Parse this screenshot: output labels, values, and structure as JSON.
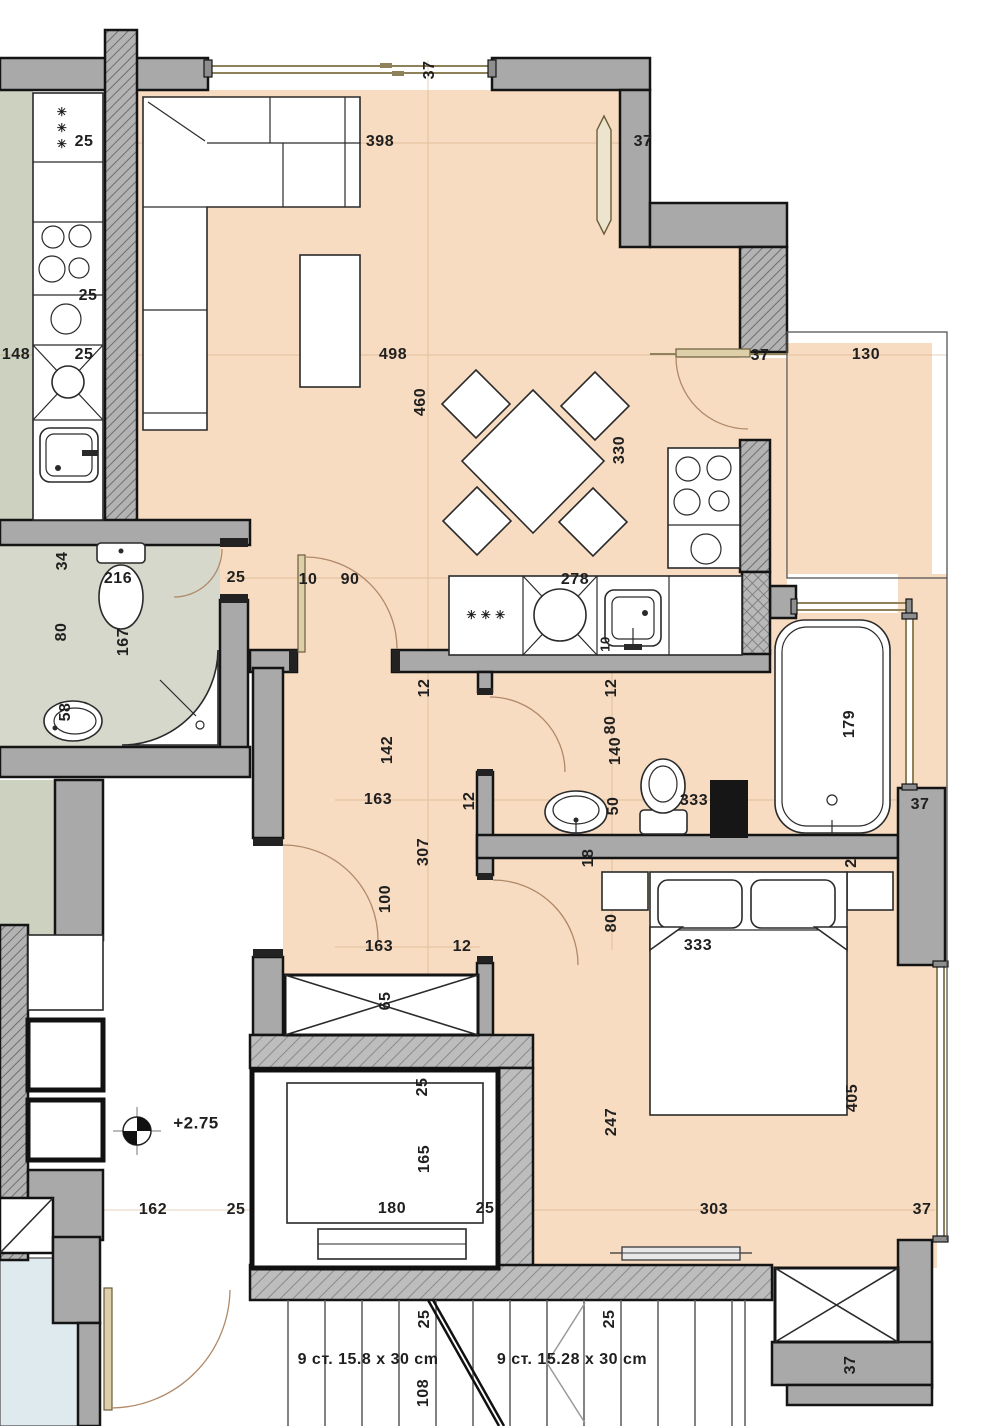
{
  "plan_title": "apartment floor plan",
  "colors": {
    "peach": "#f8dcc2",
    "wall_gray": "#a9a9a9",
    "hatch_gray": "#b3b3b3",
    "hatch_line": "#6e6e6e",
    "green_floor": "#d5d8ca",
    "green_strip": "#ccd2bf",
    "blue_floor": "#dfeaee",
    "window_tan": "#8f815a",
    "outline": "#141414",
    "label_color": "#1f1f1f"
  },
  "level_marker": "+2.75",
  "stairs": {
    "left_flight": "9 ст. 15.8 x 30 cm",
    "right_flight": "9 ст. 15.28 x 30 cm"
  },
  "labels": [
    {
      "t": "37",
      "x": 430,
      "y": 70,
      "r": -90
    },
    {
      "t": "25",
      "x": 84,
      "y": 142,
      "r": 0
    },
    {
      "t": "398",
      "x": 380,
      "y": 142,
      "r": 0
    },
    {
      "t": "37",
      "x": 643,
      "y": 142,
      "r": 0
    },
    {
      "t": "25",
      "x": 88,
      "y": 296,
      "r": 0
    },
    {
      "t": "148",
      "x": 16,
      "y": 355,
      "r": 0
    },
    {
      "t": "25",
      "x": 84,
      "y": 355,
      "r": 0
    },
    {
      "t": "498",
      "x": 393,
      "y": 355,
      "r": 0
    },
    {
      "t": "37",
      "x": 760,
      "y": 356,
      "r": 0
    },
    {
      "t": "130",
      "x": 866,
      "y": 355,
      "r": 0
    },
    {
      "t": "460",
      "x": 421,
      "y": 402,
      "r": -90
    },
    {
      "t": "330",
      "x": 620,
      "y": 450,
      "r": -90
    },
    {
      "t": "34",
      "x": 63,
      "y": 561,
      "r": -90
    },
    {
      "t": "216",
      "x": 118,
      "y": 579,
      "r": 0
    },
    {
      "t": "25",
      "x": 236,
      "y": 578,
      "r": 0
    },
    {
      "t": "10",
      "x": 308,
      "y": 580,
      "r": 0
    },
    {
      "t": "90",
      "x": 350,
      "y": 580,
      "r": 0
    },
    {
      "t": "278",
      "x": 575,
      "y": 580,
      "r": 0
    },
    {
      "t": "80",
      "x": 62,
      "y": 632,
      "r": -90
    },
    {
      "t": "167",
      "x": 124,
      "y": 642,
      "r": -90
    },
    {
      "t": "10",
      "x": 605,
      "y": 644,
      "r": -90,
      "s": 13
    },
    {
      "t": "12",
      "x": 425,
      "y": 688,
      "r": -90
    },
    {
      "t": "12",
      "x": 612,
      "y": 688,
      "r": -90
    },
    {
      "t": "58",
      "x": 66,
      "y": 712,
      "r": -90
    },
    {
      "t": "179",
      "x": 850,
      "y": 724,
      "r": -90
    },
    {
      "t": "142",
      "x": 388,
      "y": 750,
      "r": -90
    },
    {
      "t": "80",
      "x": 611,
      "y": 725,
      "r": -90
    },
    {
      "t": "140",
      "x": 616,
      "y": 751,
      "r": -90
    },
    {
      "t": "163",
      "x": 378,
      "y": 800,
      "r": 0
    },
    {
      "t": "12",
      "x": 470,
      "y": 801,
      "r": -90
    },
    {
      "t": "50",
      "x": 614,
      "y": 806,
      "r": -90
    },
    {
      "t": "333",
      "x": 694,
      "y": 801,
      "r": 0
    },
    {
      "t": "37",
      "x": 920,
      "y": 805,
      "r": 0
    },
    {
      "t": "307",
      "x": 424,
      "y": 852,
      "r": -90
    },
    {
      "t": "18",
      "x": 589,
      "y": 858,
      "r": -90
    },
    {
      "t": "2",
      "x": 852,
      "y": 863,
      "r": -90
    },
    {
      "t": "100",
      "x": 386,
      "y": 899,
      "r": -90
    },
    {
      "t": "80",
      "x": 612,
      "y": 923,
      "r": -90
    },
    {
      "t": "163",
      "x": 379,
      "y": 947,
      "r": 0
    },
    {
      "t": "12",
      "x": 462,
      "y": 947,
      "r": 0
    },
    {
      "t": "333",
      "x": 698,
      "y": 946,
      "r": 0
    },
    {
      "t": "65",
      "x": 386,
      "y": 1001,
      "r": -90
    },
    {
      "t": "+2.75",
      "x": 196,
      "y": 1123,
      "r": 0,
      "s": 17
    },
    {
      "t": "25",
      "x": 423,
      "y": 1087,
      "r": -90
    },
    {
      "t": "165",
      "x": 425,
      "y": 1159,
      "r": -90
    },
    {
      "t": "405",
      "x": 853,
      "y": 1098,
      "r": -90
    },
    {
      "t": "247",
      "x": 612,
      "y": 1122,
      "r": -90
    },
    {
      "t": "162",
      "x": 153,
      "y": 1210,
      "r": 0
    },
    {
      "t": "25",
      "x": 236,
      "y": 1210,
      "r": 0
    },
    {
      "t": "180",
      "x": 392,
      "y": 1209,
      "r": 0
    },
    {
      "t": "25",
      "x": 485,
      "y": 1209,
      "r": 0
    },
    {
      "t": "303",
      "x": 714,
      "y": 1210,
      "r": 0
    },
    {
      "t": "37",
      "x": 922,
      "y": 1210,
      "r": 0
    },
    {
      "t": "25",
      "x": 425,
      "y": 1319,
      "r": -90
    },
    {
      "t": "25",
      "x": 610,
      "y": 1319,
      "r": -90
    },
    {
      "t": "9 ст. 15.8 x 30 cm",
      "x": 368,
      "y": 1360,
      "r": 0,
      "s": 16,
      "w": 700
    },
    {
      "t": "9 ст. 15.28 x 30 cm",
      "x": 572,
      "y": 1360,
      "r": 0,
      "s": 16,
      "w": 700
    },
    {
      "t": "108",
      "x": 424,
      "y": 1393,
      "r": -90
    },
    {
      "t": "37",
      "x": 851,
      "y": 1365,
      "r": -90
    },
    {
      "t": "✳",
      "x": 62,
      "y": 112,
      "r": 0,
      "s": 12
    },
    {
      "t": "✳",
      "x": 62,
      "y": 128,
      "r": 0,
      "s": 12
    },
    {
      "t": "✳",
      "x": 62,
      "y": 144,
      "r": 0,
      "s": 12
    },
    {
      "t": "✳ ✳ ✳",
      "x": 486,
      "y": 615,
      "r": 0,
      "s": 12
    }
  ]
}
